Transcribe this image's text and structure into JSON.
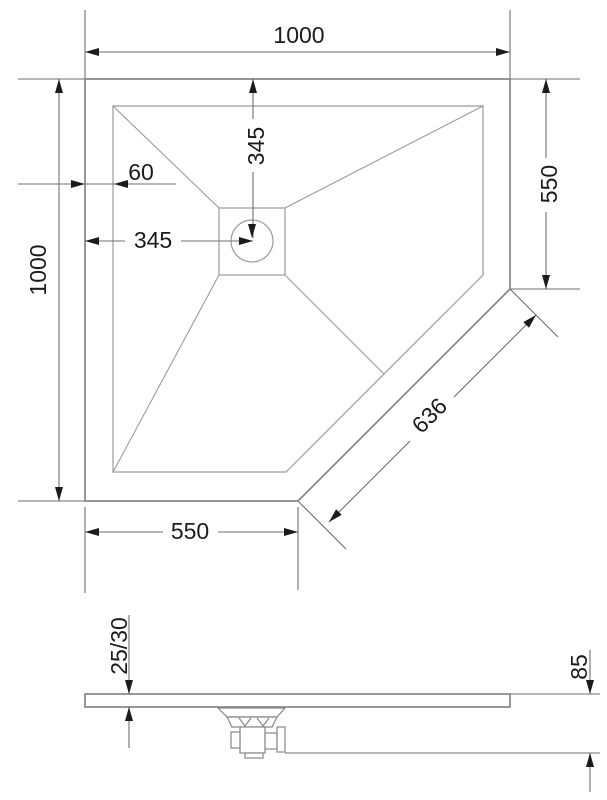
{
  "background": "#ffffff",
  "colors": {
    "outline": "#878787",
    "inner_line": "#9b9b9b",
    "dimension_line": "#6f6f6f",
    "arrow": "#1b1b1b",
    "label": "#1b1b1b"
  },
  "plan_view": {
    "title": "shower tray plan view",
    "dimensions": {
      "top_width": "1000",
      "left_height": "1000",
      "rim_width": "60",
      "drain_offset_x": "345",
      "drain_offset_y": "345",
      "right_side": "550",
      "diagonal_cut": "636",
      "bottom_side": "550"
    }
  },
  "side_view": {
    "title": "shower tray side profile",
    "dimensions": {
      "tray_thickness": "25/30",
      "overall_height": "85"
    }
  }
}
